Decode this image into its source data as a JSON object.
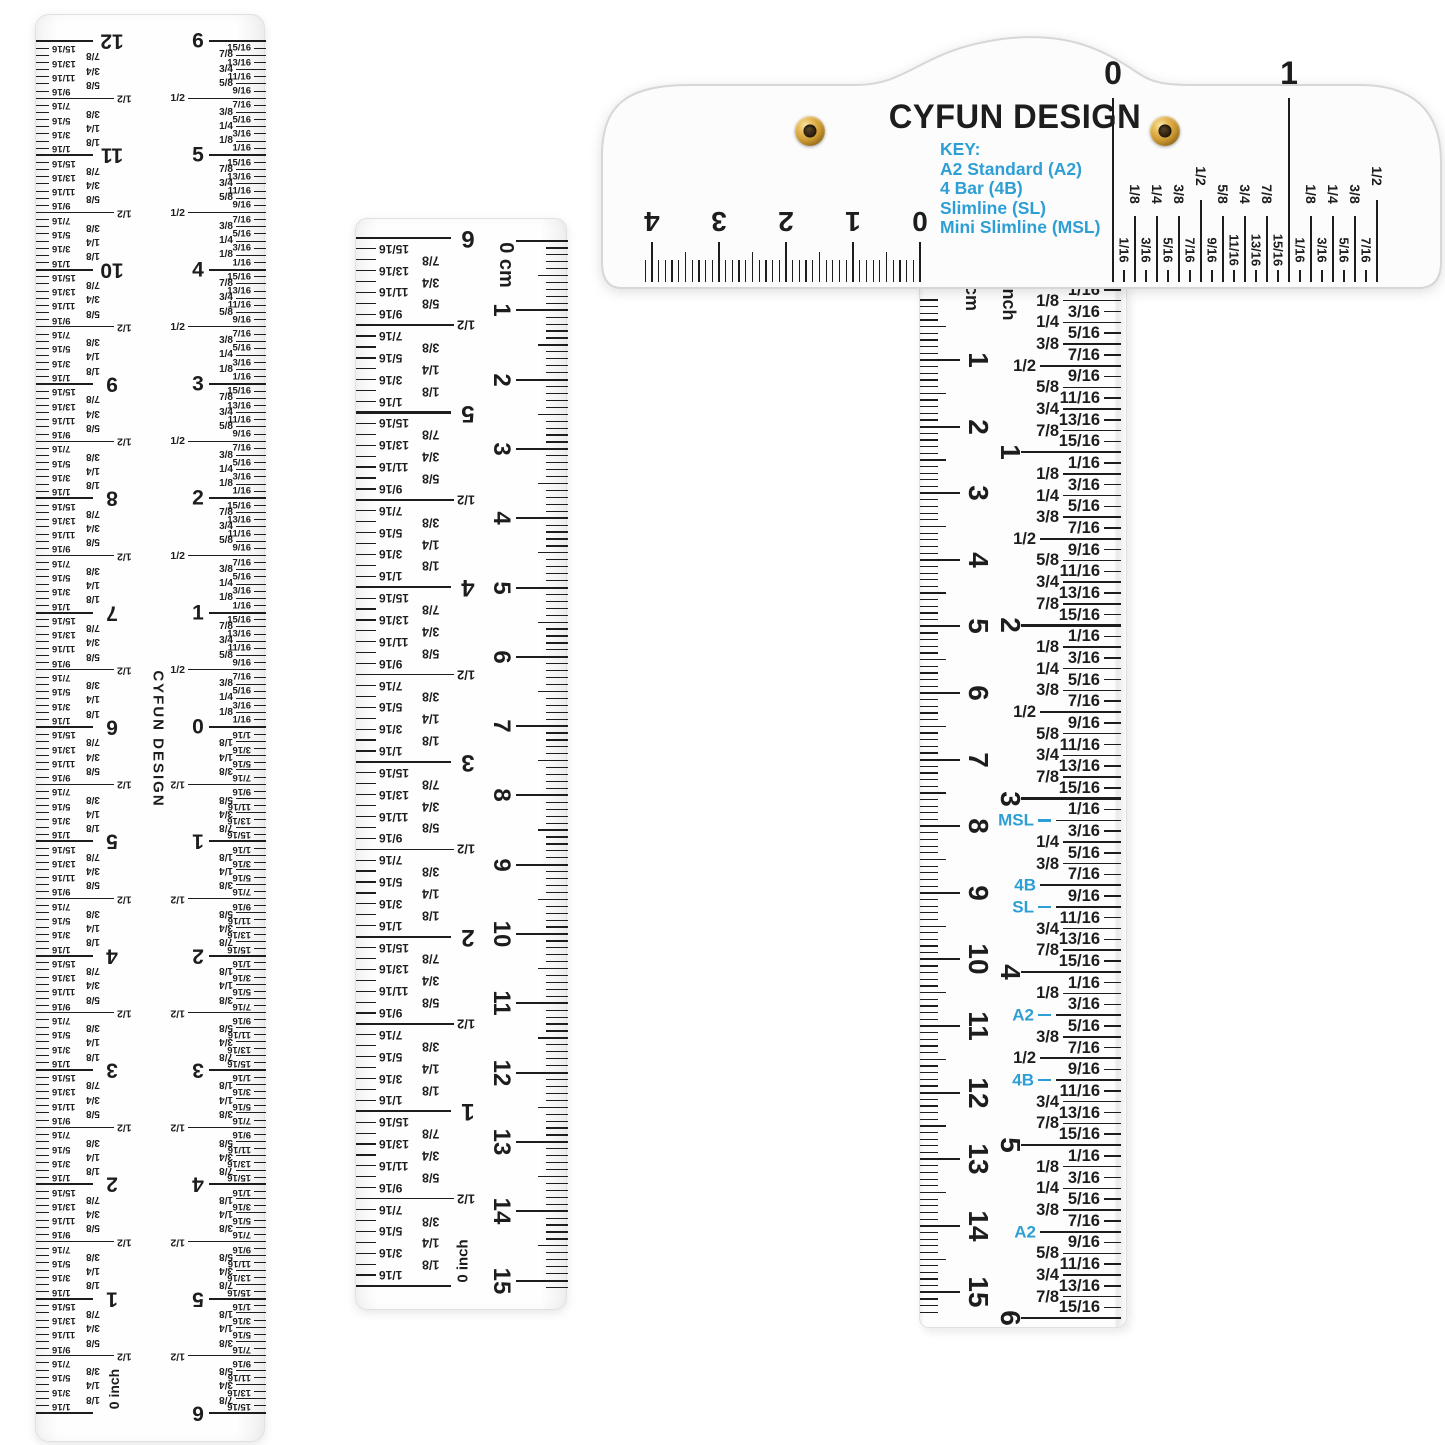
{
  "brand": "CYFUN DESIGN",
  "colors": {
    "accent_blue": "#2e9fd4",
    "ink": "#1d1d1d",
    "eyelet_gold": "#c8962f",
    "eyelet_hole": "#241a0c"
  },
  "fractions": {
    "sixteenths": [
      "1/16",
      "3/16",
      "5/16",
      "7/16",
      "9/16",
      "11/16",
      "13/16",
      "15/16"
    ],
    "eighths": [
      "1/8",
      "1/4",
      "3/8",
      "1/2",
      "5/8",
      "3/4",
      "7/8"
    ]
  },
  "left_ruler": {
    "brand_vertical": "CYFUN DESIGN",
    "inch_scale": {
      "unit_label": "0 inch",
      "numbers_top_down": [
        "12",
        "11",
        "10",
        "9",
        "8",
        "7",
        "6",
        "5",
        "4",
        "3",
        "2",
        "1"
      ]
    },
    "center_scale": {
      "numbers_top": [
        "6",
        "5",
        "4",
        "3",
        "2",
        "1"
      ],
      "center_label": "0",
      "numbers_bottom": [
        "1",
        "2",
        "3",
        "4",
        "5",
        "6"
      ]
    }
  },
  "middle_ruler": {
    "inch_scale": {
      "unit_label": "0 inch",
      "numbers_top_down": [
        "6",
        "5",
        "4",
        "3",
        "2",
        "1"
      ]
    },
    "cm_scale": {
      "unit_label": "0 cm",
      "numbers": [
        "1",
        "2",
        "3",
        "4",
        "5",
        "6",
        "7",
        "8",
        "9",
        "10",
        "11",
        "12",
        "13",
        "14",
        "15"
      ]
    }
  },
  "tsquare": {
    "brand": "CYFUN DESIGN",
    "key": {
      "title": "KEY:",
      "items": [
        "A2 Standard (A2)",
        "4 Bar (4B)",
        "Slimline (SL)",
        "Mini Slimline (MSL)"
      ]
    },
    "head_cm_numbers": [
      "4",
      "3",
      "2",
      "1",
      "0"
    ],
    "head_inch_numbers": [
      "0",
      "1"
    ],
    "beam_cm": {
      "unit": "cm",
      "numbers": [
        "1",
        "2",
        "3",
        "4",
        "5",
        "6",
        "7",
        "8",
        "9",
        "10",
        "11",
        "12",
        "13",
        "14",
        "15"
      ]
    },
    "beam_inch": {
      "unit": "inch",
      "numbers": [
        "1",
        "2",
        "3",
        "4",
        "5",
        "6"
      ]
    },
    "blue_marks": [
      {
        "label": "MSL",
        "inch": 3,
        "sixteenth": 2,
        "dash": true
      },
      {
        "label": "4B",
        "inch": 3,
        "sixteenth": 8,
        "dash": false
      },
      {
        "label": "SL",
        "inch": 3,
        "sixteenth": 10,
        "dash": true
      },
      {
        "label": "A2",
        "inch": 4,
        "sixteenth": 4,
        "dash": true
      },
      {
        "label": "4B",
        "inch": 4,
        "sixteenth": 10,
        "dash": true
      },
      {
        "label": "A2",
        "inch": 5,
        "sixteenth": 8,
        "dash": false
      }
    ]
  }
}
